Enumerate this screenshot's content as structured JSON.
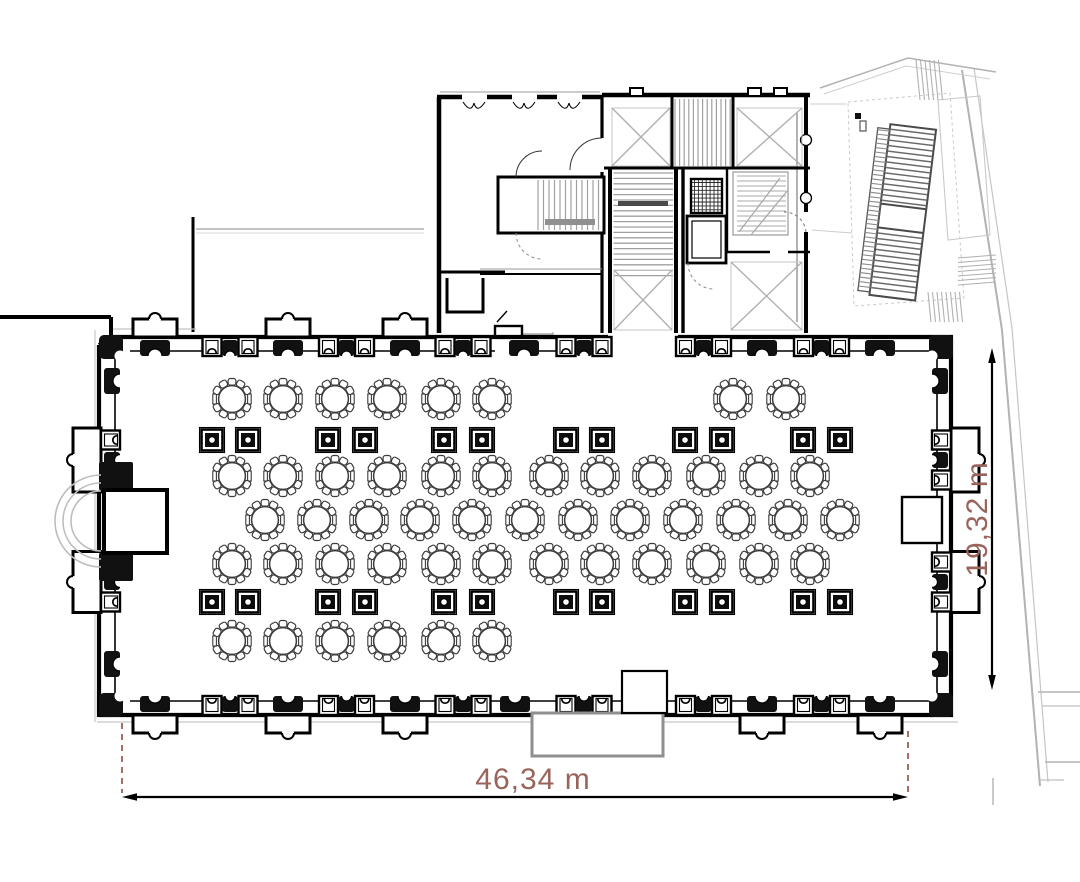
{
  "document": {
    "type": "architectural-floor-plan",
    "subject": "banquet-hall-level-plan"
  },
  "dimensions": {
    "width": {
      "label": "46,34 m"
    },
    "height": {
      "label": "19,32 m"
    },
    "text_color": "#99655b",
    "extension_line_color": "#9a6055",
    "line_color": "#000000"
  },
  "hall": {
    "tables": {
      "total": 50,
      "seats_per_table": 10,
      "table_radius": 13.4,
      "rows": [
        {
          "y": 399,
          "xs": [
            232,
            283,
            335,
            387,
            441,
            492,
            733,
            786
          ]
        },
        {
          "y": 476,
          "xs": [
            232,
            283,
            335,
            387,
            441,
            492,
            549,
            600,
            652,
            706,
            759,
            810
          ]
        },
        {
          "y": 520,
          "xs": [
            265,
            317,
            369,
            420,
            472,
            525,
            578,
            630,
            683,
            736,
            788,
            840
          ]
        },
        {
          "y": 564,
          "xs": [
            232,
            283,
            335,
            387,
            441,
            492,
            549,
            600,
            652,
            706,
            759,
            810
          ]
        },
        {
          "y": 641,
          "xs": [
            232,
            283,
            335,
            387,
            441,
            492
          ]
        }
      ]
    },
    "columns": {
      "total": 24,
      "rows": [
        {
          "y": 440,
          "xs": [
            212,
            248,
            328,
            365,
            444,
            482,
            566,
            602,
            685,
            722,
            803,
            840
          ]
        },
        {
          "y": 602,
          "xs": [
            212,
            248,
            328,
            365,
            444,
            482,
            566,
            602,
            685,
            722,
            803,
            840
          ]
        }
      ]
    }
  }
}
